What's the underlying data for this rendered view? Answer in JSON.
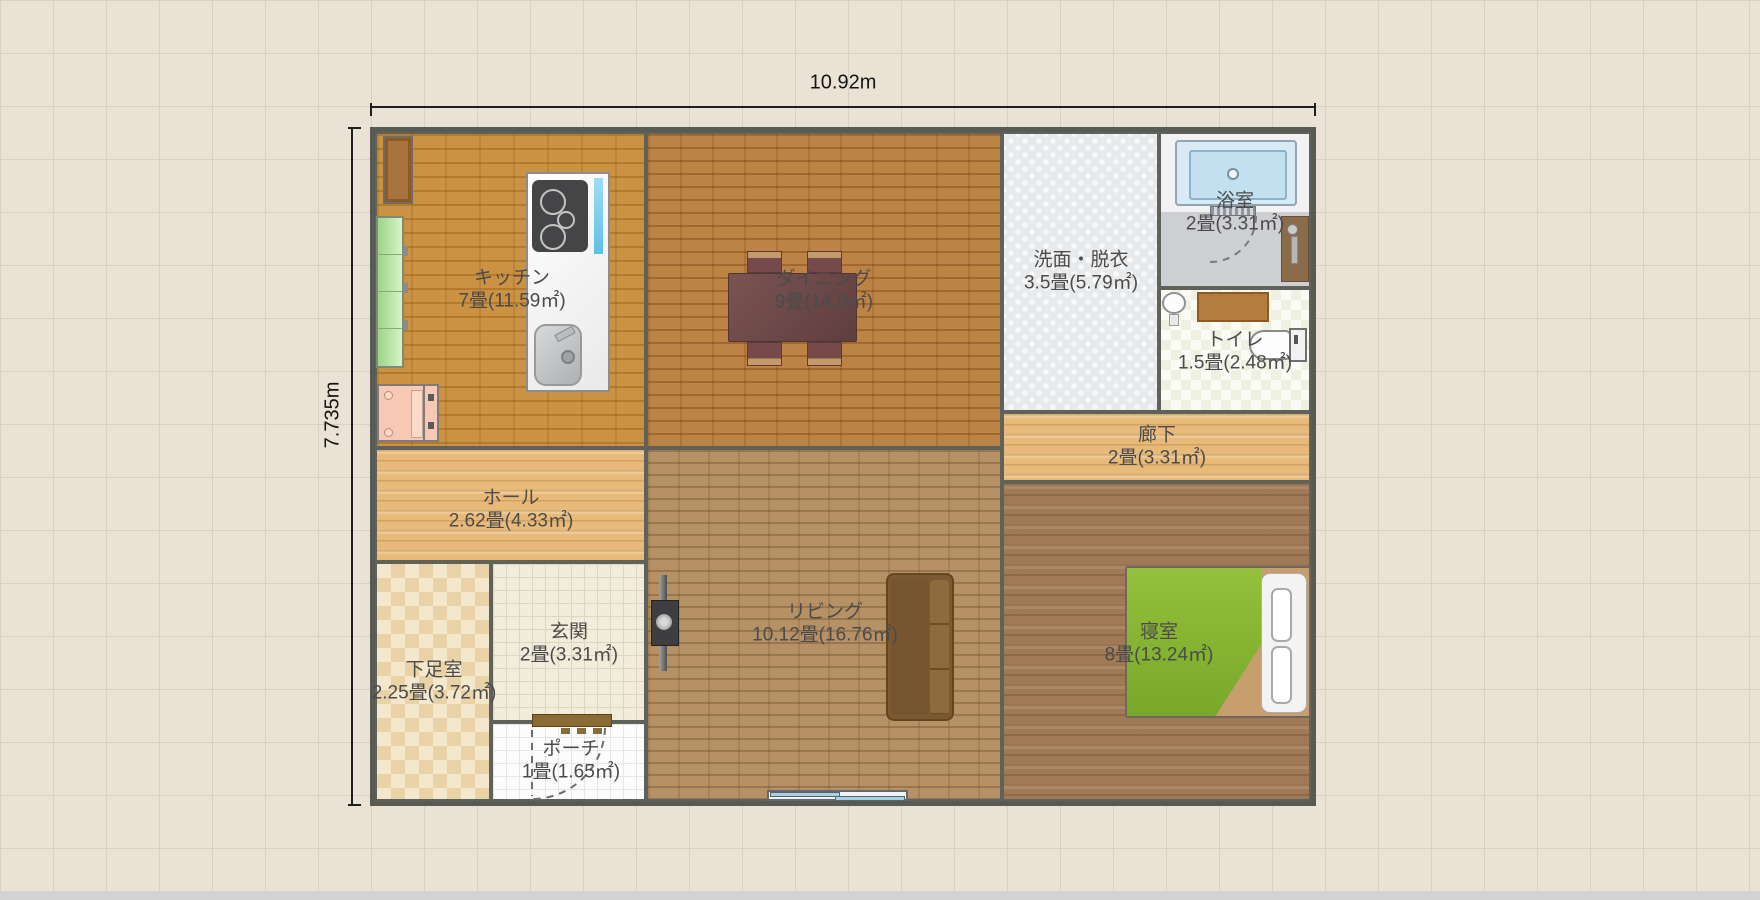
{
  "dimensions": {
    "width": "10.92m",
    "height": "7.735m"
  },
  "rooms": [
    {
      "id": "kitchen",
      "name": "キッチン",
      "area": "7畳(11.59㎡)"
    },
    {
      "id": "dining",
      "name": "ダイニング",
      "area": "9畳(14.9㎡)"
    },
    {
      "id": "washroom",
      "name": "洗面・脱衣",
      "area": "3.5畳(5.79㎡)"
    },
    {
      "id": "bath",
      "name": "浴室",
      "area": "2畳(3.31㎡)"
    },
    {
      "id": "toilet",
      "name": "トイレ",
      "area": "1.5畳(2.48㎡)"
    },
    {
      "id": "corridor",
      "name": "廊下",
      "area": "2畳(3.31㎡)"
    },
    {
      "id": "hall",
      "name": "ホール",
      "area": "2.62畳(4.33㎡)"
    },
    {
      "id": "shoes",
      "name": "下足室",
      "area": "2.25畳(3.72㎡)"
    },
    {
      "id": "entrance",
      "name": "玄関",
      "area": "2畳(3.31㎡)"
    },
    {
      "id": "porch",
      "name": "ポーチ",
      "area": "1畳(1.65㎡)"
    },
    {
      "id": "living",
      "name": "リビング",
      "area": "10.12畳(16.76㎡)"
    },
    {
      "id": "bedroom",
      "name": "寝室",
      "area": "8畳(13.24㎡)"
    }
  ],
  "furniture": [
    {
      "name": "wall-cabinet",
      "room": "kitchen"
    },
    {
      "name": "shelf-unit",
      "room": "kitchen"
    },
    {
      "name": "refrigerator",
      "room": "kitchen"
    },
    {
      "name": "counter",
      "room": "kitchen"
    },
    {
      "name": "gas-stove",
      "room": "kitchen"
    },
    {
      "name": "kitchen-sink",
      "room": "kitchen"
    },
    {
      "name": "dining-table-with-4-chairs",
      "room": "dining"
    },
    {
      "name": "tv",
      "room": "living"
    },
    {
      "name": "sofa",
      "room": "living"
    },
    {
      "name": "sliding-window",
      "room": "living"
    },
    {
      "name": "double-bed",
      "room": "bedroom"
    },
    {
      "name": "bathtub",
      "room": "bath"
    },
    {
      "name": "shower",
      "room": "bath"
    },
    {
      "name": "folding-bath-door",
      "room": "bath"
    },
    {
      "name": "hand-basin",
      "room": "toilet"
    },
    {
      "name": "counter-shelf",
      "room": "toilet"
    },
    {
      "name": "toilet-bowl",
      "room": "toilet"
    },
    {
      "name": "front-door",
      "room": "porch"
    }
  ],
  "colors": {
    "background": "#eae3d5",
    "wall": "#575b54",
    "kitchen_floor": "#cb9243",
    "dining_floor": "#bd8345",
    "living_floor": "#b69166",
    "bedroom_floor": "#a9815a",
    "hall_floor": "#e7ba79",
    "bed_green": "#84b02e",
    "bathtub_blue": "#c2e0f0"
  }
}
